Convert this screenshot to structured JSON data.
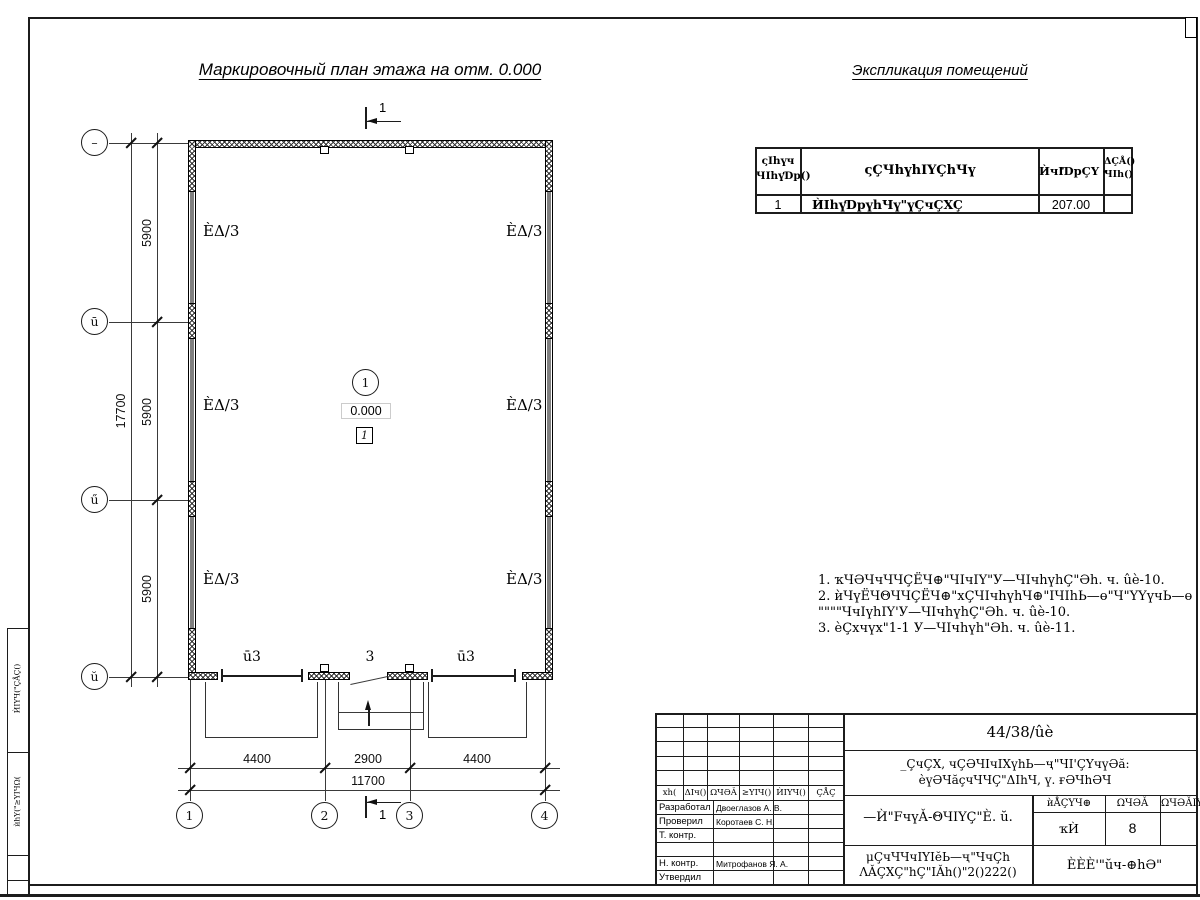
{
  "titles": {
    "plan": "Маркировочный план этажа на отм. 0.000",
    "explication": "Экспликация помещений"
  },
  "explication_table": {
    "col1_line1": "ςIhүч",
    "col1_line2": "ЧIhүƊp()",
    "col2": "ςÇЧhүhIYÇhЧү",
    "col3": "ЍчIƊpÇҮ -",
    "col4_line1": "ΔÇÅ()",
    "col4_line2": "ЧIh()",
    "row": {
      "num": "1",
      "name": "ЍIhүƊpүhЧү\"үÇчÇXÇ",
      "area": "207.00",
      "note": ""
    }
  },
  "notes": {
    "line1": "1. ҡЧӘЧчЧЧÇЁЧ⊕\"ЧIчIY\"У—ЧIчhүhÇ\"Әh. ч. ûè-10.",
    "line2": "2. ѝЧүЁЧΘЧЧÇЁЧ⊕\"хÇЧIчhүhЧ⊕\"IЧIhЬ—ө\"Ч\"YҮүчЬ—ө",
    "line3": "\"\"\"\"ЧчIүhIY'У—ЧIчhүhÇ\"Әh. ч. ûè-10.",
    "line4": "3. ѐÇхчүх\"1-1 У—ЧIчhүh\"Әh. ч. ûè-11."
  },
  "plan": {
    "axes_left": [
      "–",
      "ū",
      "ű",
      "ŭ"
    ],
    "axes_bottom": [
      "1",
      "2",
      "3",
      "4"
    ],
    "dims_vertical": [
      "5900",
      "5900",
      "5900"
    ],
    "dim_vertical_total": "17700",
    "dims_horizontal": [
      "4400",
      "2900",
      "4400"
    ],
    "dim_horizontal_total": "11700",
    "room_labels": [
      "ÈΔ/3",
      "ÈΔ/3",
      "ÈΔ/3",
      "ÈΔ/3",
      "ÈΔ/3",
      "ÈΔ/3"
    ],
    "bottom_labels": [
      "ū3",
      "3",
      "ū3"
    ],
    "room_number": "1",
    "elevation": "0.000",
    "boxed_number": "1",
    "section_mark": "1"
  },
  "title_block": {
    "doc_number": "44/38/ûè",
    "project_line1": "_ÇчÇX, чÇӘЧIчIXүhЬ—ҷ\"ЧI'ÇҮчүӘă:",
    "project_line2": "ѐүӘЧăҫчЧЧÇ\"ΔIhЧ, ү. ғӘЧhӘЧ",
    "grid_headers": [
      "хh(",
      "ΔIч()",
      "ΩЧӘǍ",
      "≥YIЧ()",
      "ЍIYЧ()",
      "ÇÅÇ"
    ],
    "roles": [
      {
        "label": "Разработал",
        "name": "Двоеглазов А. В."
      },
      {
        "label": "Проверил",
        "name": "Коротаев С. Н."
      },
      {
        "label": "Т. контр.",
        "name": ""
      },
      {
        "label": "",
        "name": ""
      },
      {
        "label": "Н. контр.",
        "name": "Митрофанов Я. А."
      },
      {
        "label": "Утвердил",
        "name": ""
      }
    ],
    "sheet_title": "—Ѝ\"FчүǍ-ΘЧIYÇ\"È. ŭ.",
    "stage_header": [
      "ѝÅÇҮЧ⊕",
      "ΩЧӘǍ",
      "ΩЧӘǍIY"
    ],
    "stage_values": [
      "ҡЍ",
      "8",
      ""
    ],
    "org_line1": "μÇчЧЧчIYIĕЬ—ҷ\"ЧчÇh",
    "org_line2": "ΛǍÇXÇ\"hÇ\"IǍh()\"2()222()",
    "logo": "ÈÈÈ'\"ŭч-⊕hӘ\""
  },
  "side_stamp": {
    "cell1": "ЍIYЧ(\"ÇÅÇ()",
    "cell2": "ѝhY(\"≥YIЧΩ("
  }
}
